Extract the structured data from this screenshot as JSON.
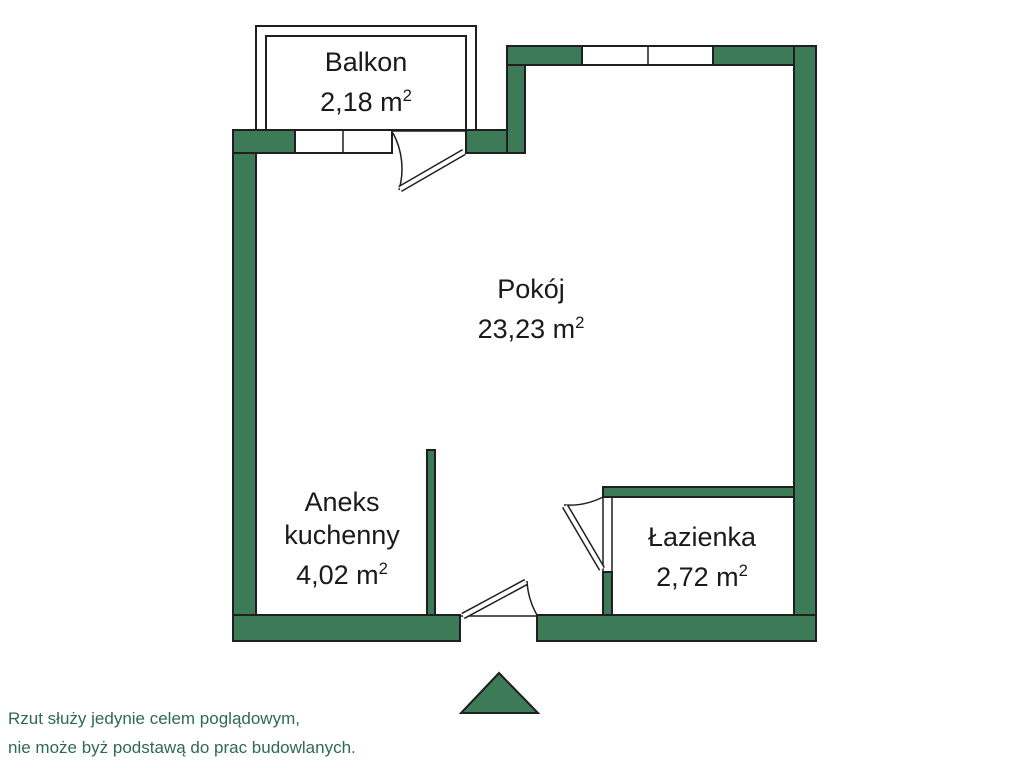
{
  "colors": {
    "wall": "#3C7A58",
    "outline": "#1F1F1F",
    "text": "#1A1A1A",
    "disclaimer": "#2E6A4E",
    "bg": "#FFFFFF"
  },
  "icons": {
    "entrance_marker": "triangle-up"
  },
  "plan": {
    "rooms": [
      {
        "name_line1": "Balkon",
        "area": "2,18 m",
        "area_sup": "2"
      },
      {
        "name_line1": "Pokój",
        "area": "23,23 m",
        "area_sup": "2"
      },
      {
        "name_line1": "Aneks",
        "name_line2": "kuchenny",
        "area": "4,02 m",
        "area_sup": "2"
      },
      {
        "name_line1": "Łazienka",
        "area": "2,72 m",
        "area_sup": "2"
      }
    ]
  },
  "disclaimer": {
    "line1": "Rzut służy jedynie celem poglądowym,",
    "line2": "nie może byż podstawą do prac budowlanych."
  }
}
